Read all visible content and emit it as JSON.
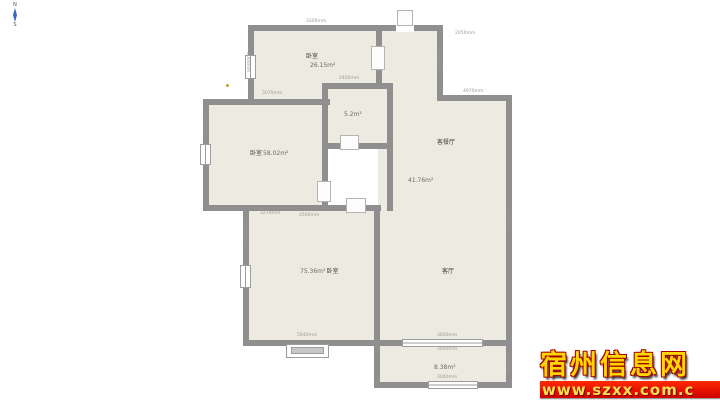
{
  "compass": {
    "north": "N",
    "south": "S"
  },
  "rooms": {
    "top_bedroom": {
      "name": "卧室",
      "area": "26.15m²"
    },
    "mid_bedroom": {
      "name": "卧室",
      "area": "58.02m²"
    },
    "bathroom": {
      "area": "5.2m²"
    },
    "living_dining": {
      "name": "客餐厅",
      "area": "41.76m²"
    },
    "living": {
      "name": "客厅"
    },
    "bottom_bedroom": {
      "area": "75.36m²",
      "name": "卧室"
    },
    "balcony": {
      "area": "8.38m²"
    }
  },
  "dims": [
    {
      "text": "3300mm"
    },
    {
      "text": "2400mm"
    },
    {
      "text": "3070mm"
    },
    {
      "text": "2050mm"
    },
    {
      "text": "4970mm"
    },
    {
      "text": "3270mm"
    },
    {
      "text": "4500mm"
    },
    {
      "text": "5640mm"
    },
    {
      "text": "3000mm"
    },
    {
      "text": "3000mm"
    },
    {
      "text": "3000mm"
    },
    {
      "text": "4000mm"
    },
    {
      "text": "3400mm"
    },
    {
      "text": "2410mm"
    },
    {
      "text": "4620mm"
    },
    {
      "text": "1150mm"
    },
    {
      "text": "4180mm"
    }
  ],
  "watermark": {
    "site_name": "宿州信息网",
    "site_url": "www.szxx.com.c"
  },
  "colors": {
    "wall": "#8f8f8f",
    "floor": "#edeae1",
    "accent_dot": "#c9a227",
    "compass_needle": "#3a66c9",
    "watermark_gold": "#ffd700",
    "watermark_band": "#e00000"
  }
}
